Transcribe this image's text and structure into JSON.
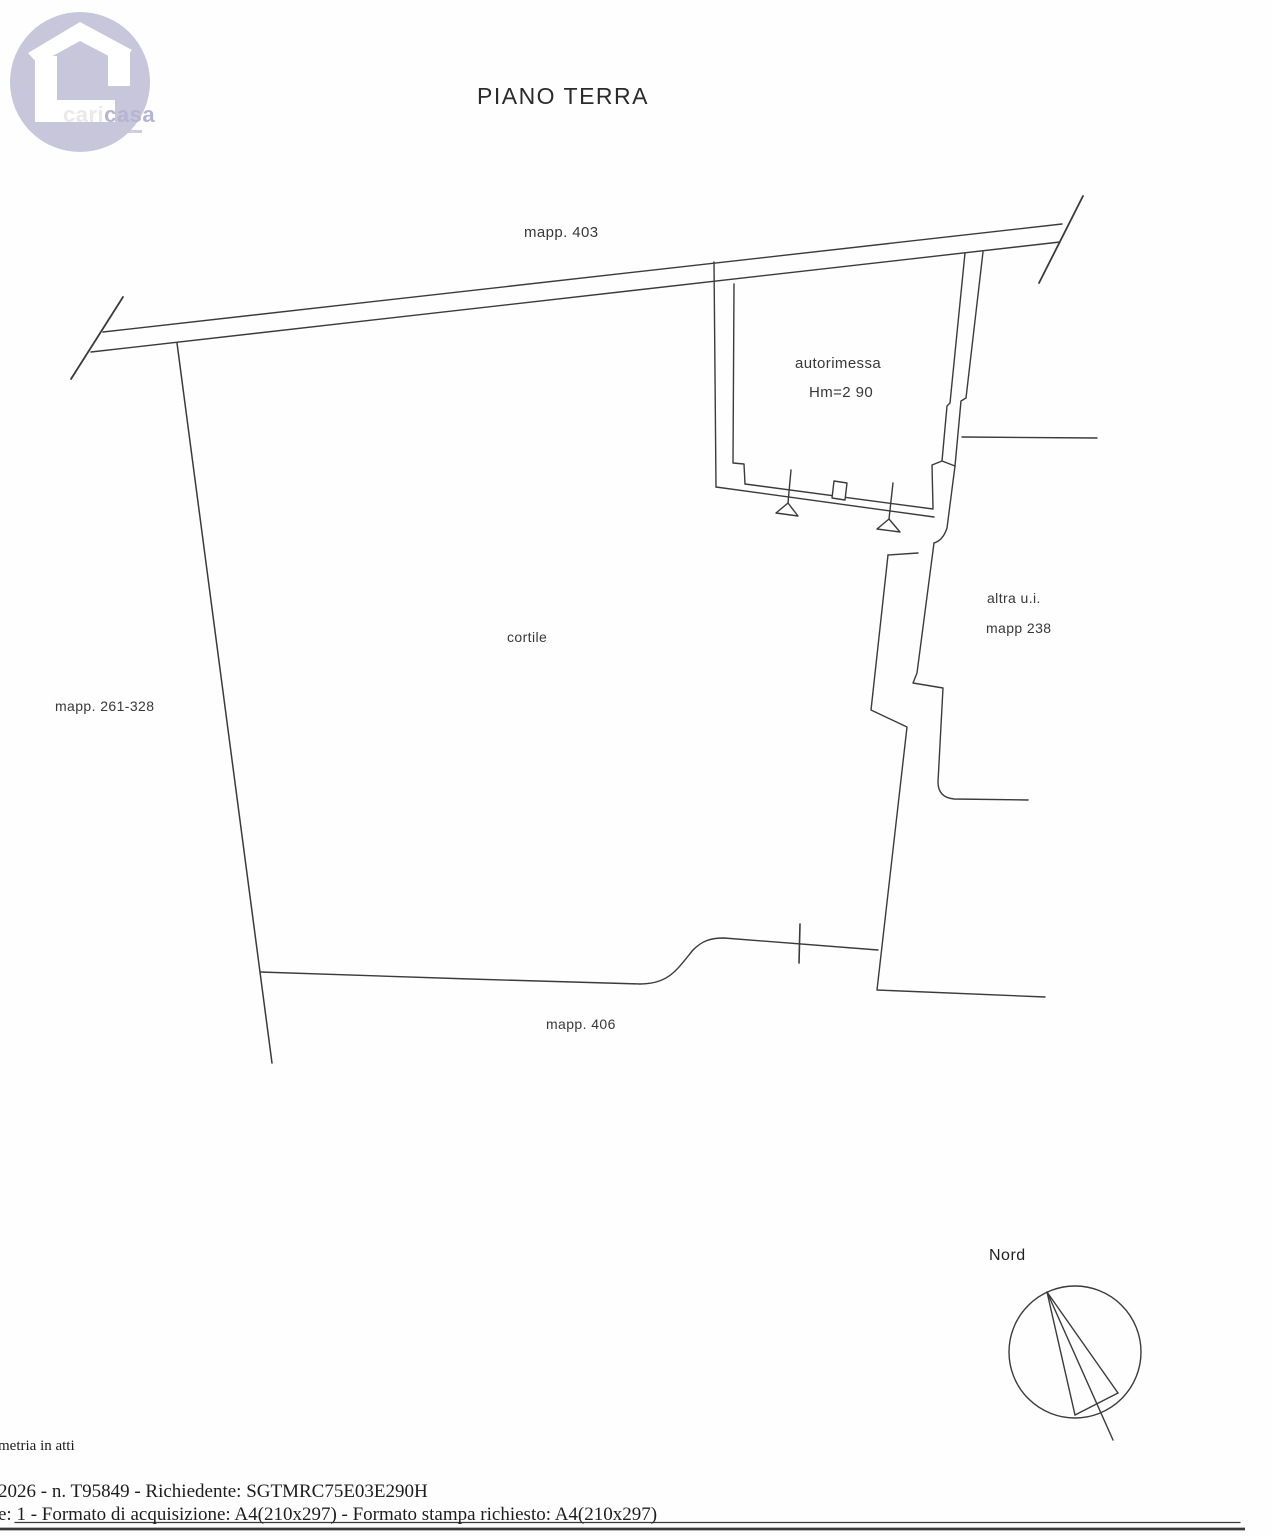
{
  "title": "PIANO TERRA",
  "logo": {
    "brand_part1": "cari",
    "brand_part2": "casa"
  },
  "plan_labels": {
    "mapp_403": "mapp. 403",
    "autorimessa": "autorimessa",
    "autorimessa_height": "Hm=2 90",
    "cortile": "cortile",
    "mapp_261_328": "mapp. 261-328",
    "altra_ui": "altra u.i.",
    "mapp_238": "mapp 238",
    "mapp_406": "mapp. 406"
  },
  "compass": {
    "label": "Nord"
  },
  "footer": {
    "line1": "metria in atti",
    "line2": "2026 - n. T95849 - Richiedente: SGTMRC75E03E290H",
    "line3": "e: 1 - Formato di acquisizione: A4(210x297) - Formato stampa richiesto: A4(210x297)"
  },
  "colors": {
    "line": "#3b3b3b",
    "text": "#383838",
    "logo_circle": "#c7c6db",
    "logo_cari": "#ece7ea",
    "logo_casa": "#b6b4d2"
  }
}
